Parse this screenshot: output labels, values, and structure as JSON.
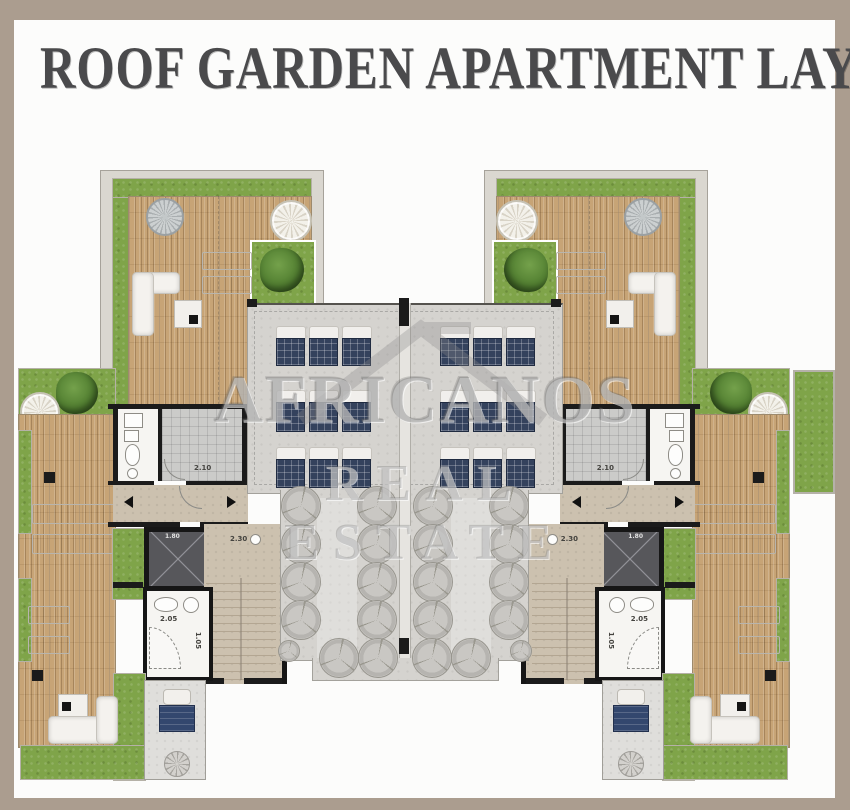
{
  "title": "ROOF GARDEN APARTMENT LAYOUT",
  "watermark": {
    "line1": "AFRICANOS",
    "line2": "REAL ESTATE"
  },
  "plan": {
    "labels": {
      "shower_room": "2.10",
      "stair_hall": "2.30",
      "elevator": "1.80",
      "bathroom_w": "2.05",
      "bathroom_h": "1.05"
    },
    "colors": {
      "frame": "#ab9d8f",
      "paper": "#fcfcfb",
      "wood_deck": "#c7a476",
      "grass": "#7fa449",
      "roof_slab": "#d5d3cf",
      "wall": "#1b1b1b",
      "solar_panel": "#34425d",
      "patio": "#dfdedb",
      "dining_table": "#33476e",
      "title_text": "#4a4a4c"
    }
  }
}
